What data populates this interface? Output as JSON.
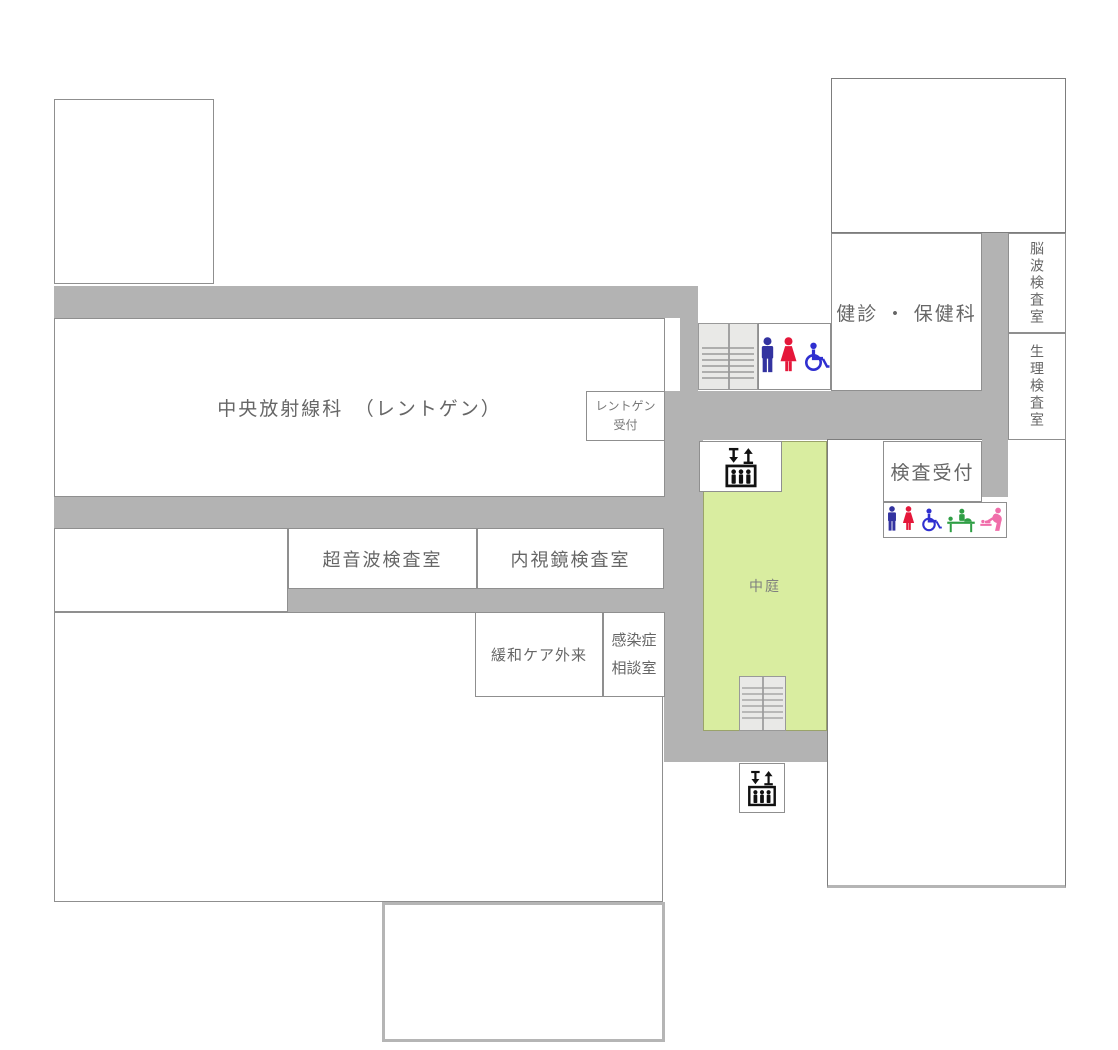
{
  "floorplan": {
    "rooms": {
      "central_radiology": "中央放射線科　（レントゲン）",
      "xray_reception_line1": "レントゲン",
      "xray_reception_line2": "受付",
      "checkup_health": "健診 ・ 保健科",
      "eeg_room": "脳波検査室",
      "physiology_room": "生理検査室",
      "exam_reception": "検査受付",
      "ultrasound_room": "超音波検査室",
      "endoscopy_room": "内視鏡検査室",
      "palliative_care": "緩和ケア外来",
      "infection_line1": "感染症",
      "infection_line2": "相談室",
      "courtyard": "中庭"
    },
    "icons": {
      "stairs": "stairs-icon",
      "elevator": "elevator-icon",
      "male_toilet": "male-toilet-icon",
      "female_toilet": "female-toilet-icon",
      "wheelchair": "wheelchair-accessible-icon",
      "changing_table": "diaper-changing-station-icon",
      "baby_care": "baby-care-icon"
    },
    "colors": {
      "corridor_gray": "#b3b3b3",
      "courtyard_green": "#d9eda0",
      "stairs_fill": "#e9e9e7",
      "room_border": "#8f8f8f",
      "label_text": "#666666",
      "male_blue": "#3333a0",
      "female_red": "#e5173a",
      "wheelchair_blue": "#2f2fd0",
      "changing_green": "#2e9e44",
      "baby_pink": "#f06eaa",
      "elevator_black": "#111111"
    }
  }
}
